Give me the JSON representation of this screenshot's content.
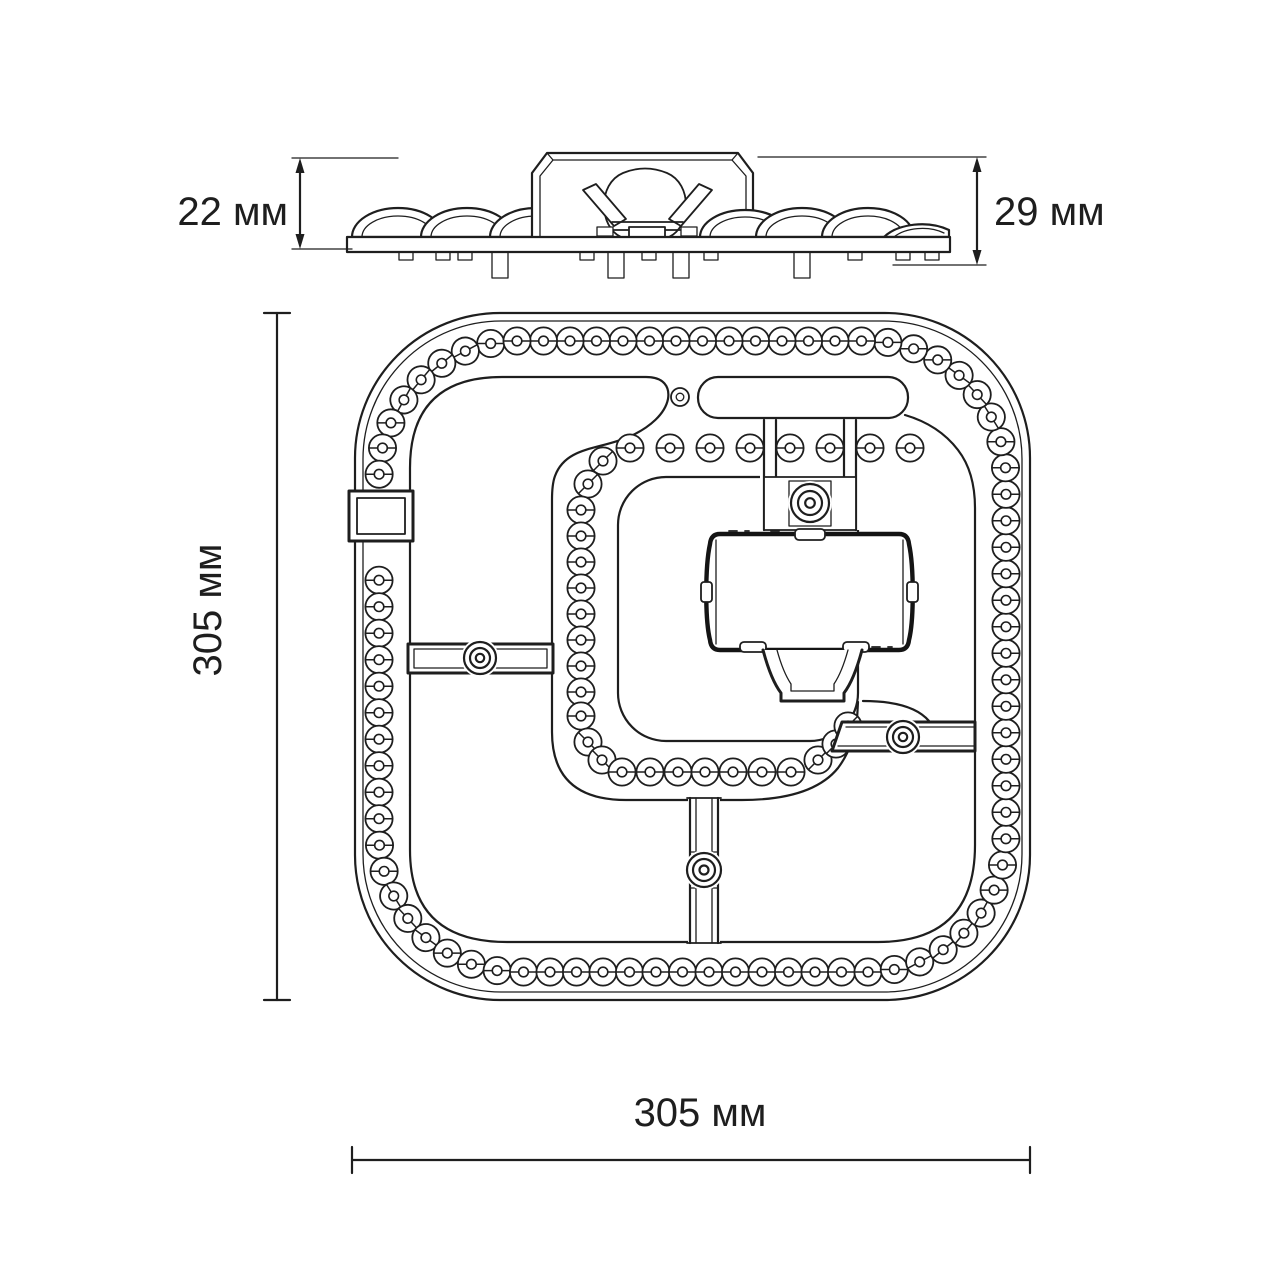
{
  "drawing_title": "LED module technical drawing",
  "units": "мм",
  "side_view": {
    "left_dimension": "22 мм",
    "right_dimension": "29 мм"
  },
  "top_view": {
    "height_dimension": "305 мм",
    "width_dimension": "305 мм"
  },
  "led_chain": {
    "outer_count": 86,
    "inner_count": 31
  },
  "colors": {
    "line": "#1e1e1e",
    "bold_line": "#141414",
    "background": "#ffffff"
  }
}
